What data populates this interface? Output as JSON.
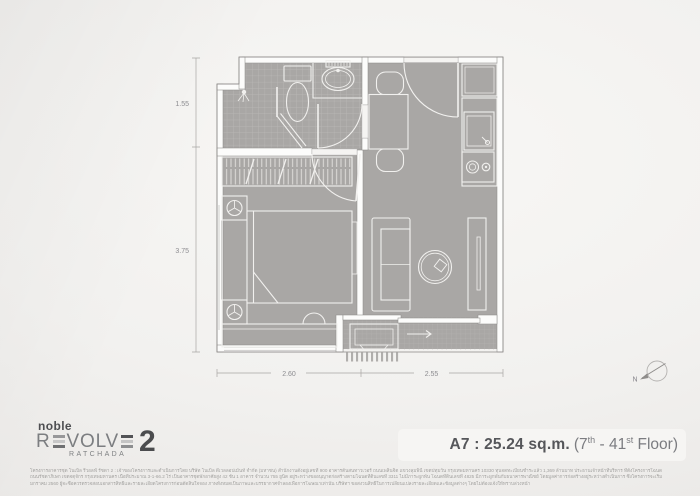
{
  "plan": {
    "dimensions": {
      "side_upper": "1.55",
      "side_lower": "3.75",
      "bottom_left": "2.60",
      "bottom_right": "2.55"
    },
    "compass_label": "N"
  },
  "footer": {
    "logo": {
      "brand": "noble",
      "rev_start": "R",
      "rev_mid": "VOLV",
      "number": "2",
      "sub": "RATCHADA"
    },
    "unit": {
      "bold": "A7 : 25.24 sq.m.",
      "paren_open": "(7",
      "sup1": "th",
      "mid": " - 41",
      "sup2": "st",
      "tail": " Floor)"
    },
    "disclaimer_lines": [
      "โครงการอาคารชุด โนเบิล รีวอลฟ์ รัชดา 2 : เจ้าของโครงการและดำเนินการโดย บริษัท โนเบิล ดีเวลลอปเม้นท์ จำกัด (มหาชน) สำนักงานตั้งอยู่เลขที่ 900 อาคารต้นสนทาวเวอร์ ถนนเพลินจิต แขวงลุมพินี เขตปทุมวัน กรุงเทพมหานคร 10330 ทุนจดทะเบียนชำระแล้ว 1,369 ล้านบาท ประธานเจ้าหน้าที่บริหาร ที่ตั้งโครงการโฉนดที่ดินเลขที่ 3211 ณ ถนนรัชดาภิเษกเลขที่ 4825",
      "ถนนรัชดาภิเษก เขตจตุจักร กรุงเทพมหานคร เนื้อที่ประมาณ 3-1-66.2 ไร่ เป็นอาคารชุดพักอาศัยสูง 42 ชั้น 1 อาคาร จำนวน 755 ยูนิต อยู่ระหว่างขออนุญาตก่อสร้างตามโฉนดที่ดินเลขที่ 3311 ไม่มีภาระผูกพัน โฉนดที่ดินเลขที่ 4825 มีภาระผูกพันกับธนาคารพาณิชย์ โดยมูลค่าการก่อสร้างอยู่ระหว่างดำเนินการ ซึ่งโครงการจะเริ่มก่อสร้างได้ประมาณเดือนพฤษภาคม 2557 คาดว่าจะแล้วเสร็จประมาณเดือน",
      "มกราคม 2560 ผู้จะซื้อควรตรวจสอบเอกสารสิทธิ์และรายละเอียดโครงการก่อนตัดสินใจจอง ภาพทั้งหมดเป็นภาพและบรรยากาศจำลองเพื่อการโฆษณาเท่านั้น บริษัทฯ ขอสงวนสิทธิ์ในการเปลี่ยนแปลงรายละเอียดและข้อมูลต่างๆ โดยไม่ต้องแจ้งให้ทราบล่วงหน้า"
    ]
  }
}
